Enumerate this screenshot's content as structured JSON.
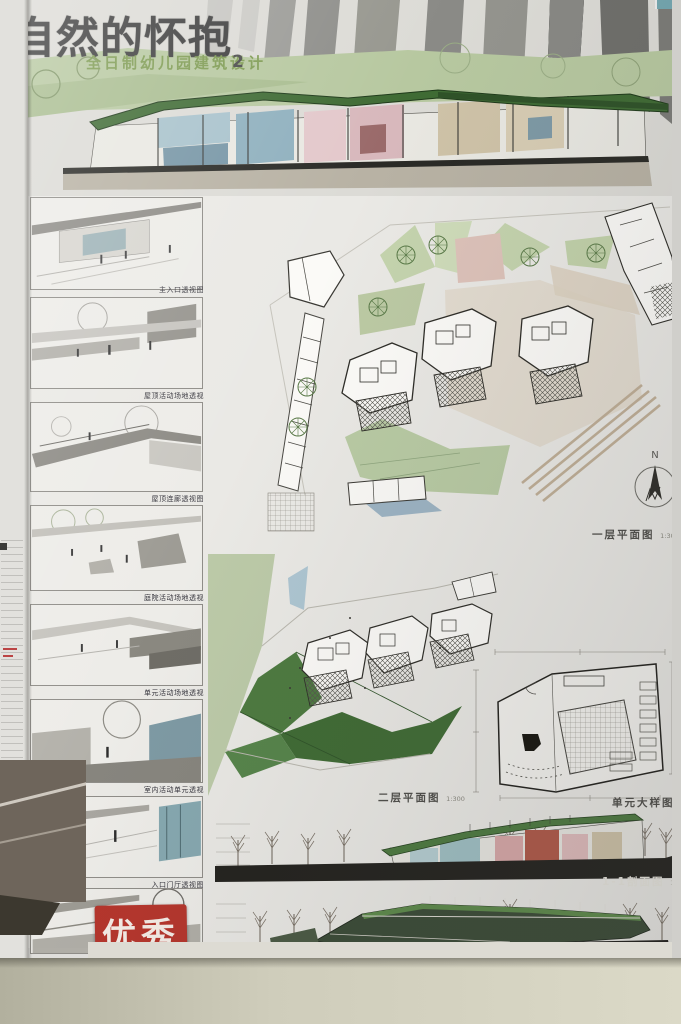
{
  "poster": {
    "title": "自然的怀抱",
    "subtitle": "全日制幼儿园建筑设计",
    "subtitle_number": "2",
    "award_stamp": "优秀",
    "colors": {
      "title_gray": "#3d3d3d",
      "subtitle_green": "#7e9b52",
      "roof_green": "#3f6b34",
      "lawn_green": "#b7c8a0",
      "room_blue": "#8fb0be",
      "room_pink": "#e3c8cb",
      "water_blue": "#9db4c4",
      "stamp_red": "#b5352c",
      "ground_dark": "#23221e"
    },
    "thumbnails": [
      {
        "caption": "主入口透视图"
      },
      {
        "caption": "屋顶活动场地透视"
      },
      {
        "caption": "屋顶连廊透视图"
      },
      {
        "caption": "庭院活动场地透视"
      },
      {
        "caption": "单元活动场地透视"
      },
      {
        "caption": "室内活动单元透视"
      },
      {
        "caption": "入口门厅透视图"
      },
      {
        "caption": ""
      }
    ],
    "drawings": {
      "first_floor": {
        "label": "一层平面图",
        "scale": "1:300"
      },
      "second_floor": {
        "label": "二层平面图",
        "scale": "1:300"
      },
      "unit_detail": {
        "label": "单元大样图",
        "scale": "1:100"
      },
      "section_1_1": {
        "label": "1-1剖面图",
        "scale": "1:300"
      },
      "west_elevation": {
        "label": "西立面图",
        "scale": "1:300"
      }
    },
    "compass": {
      "north_label": "N"
    }
  }
}
